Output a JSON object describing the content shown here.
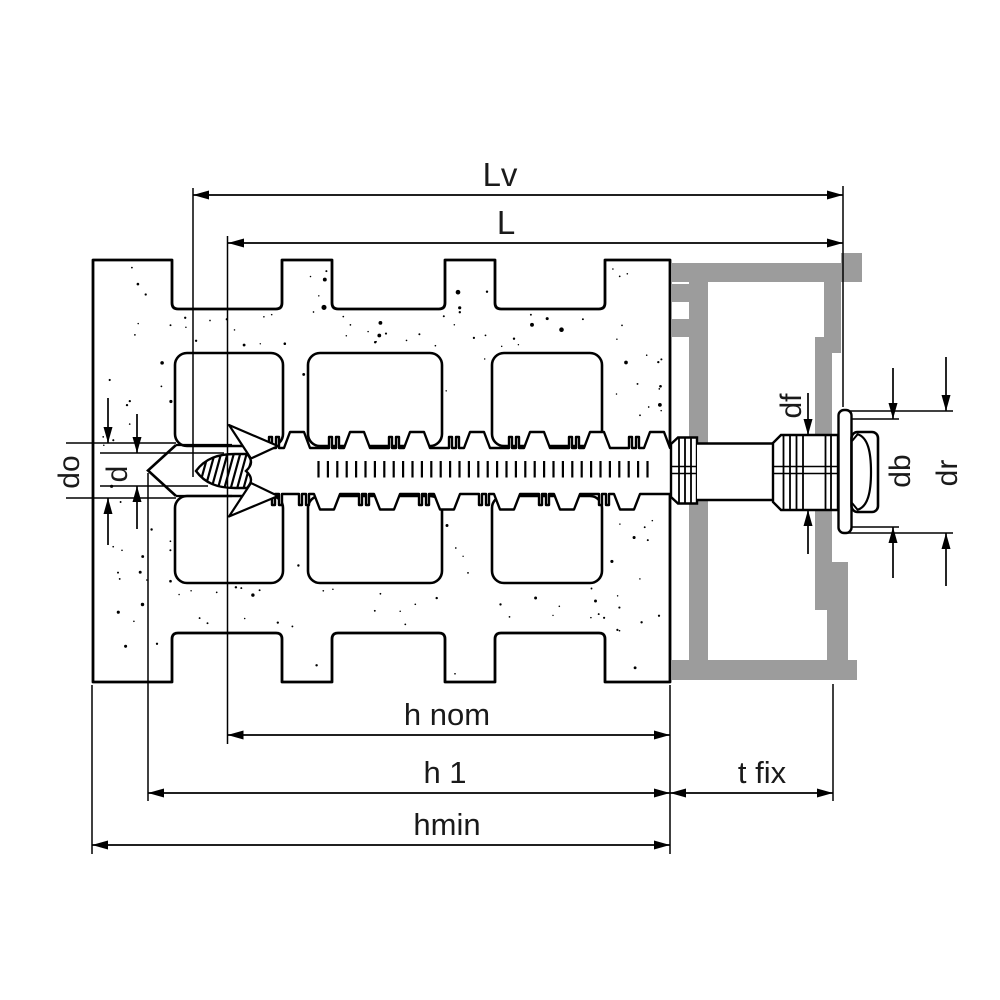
{
  "figure": {
    "kind": "technical-installation-drawing",
    "components": {
      "brick": "perforated-brick-cross-section",
      "plug": "frame-anchor-plug-with-teeth",
      "screw": "hex-flange-screw-with-washer",
      "fixture": "aluminum-frame-profile"
    }
  },
  "labels": {
    "lv": "Lv",
    "l": "L",
    "d_o": "do",
    "d": "d",
    "d_f": "df",
    "d_b": "db",
    "d_r": "dr",
    "h_nom": "h nom",
    "h_1": "h 1",
    "h_min": "hmin",
    "t_fix": "t fix"
  },
  "colors": {
    "outline": "#000000",
    "frame_gray": "#9c9c9c",
    "label_text": "#1a1a1a",
    "background": "#ffffff"
  }
}
